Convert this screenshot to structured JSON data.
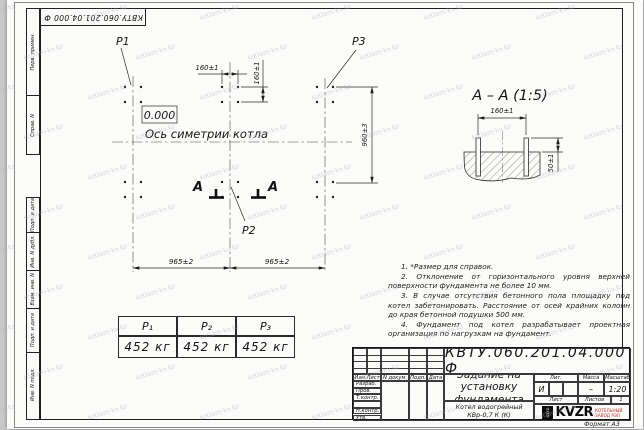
{
  "sheet": {
    "stamp_top": "КВТУ.060.201.04.000 Ф",
    "format_label": "Формат А3",
    "watermark": "kotlam-kv.kz"
  },
  "margin": {
    "perv_primen": "Перв. примен.",
    "sprav_n": "Справ. N",
    "podp_data_1": "Подп. и дата",
    "inv_dubl": "Инв. N дубл.",
    "vzam_inv": "Взам. инв. N",
    "podp_data_2": "Подп. и дата",
    "inv_podl": "Инв. N подл."
  },
  "plan": {
    "label_p1": "P1",
    "label_p2": "P2",
    "label_p3": "P3",
    "elevation": "0.000",
    "axis_label": "Ось симетрии котла",
    "dim_h160": "160±1",
    "dim_v160": "160±1",
    "dim_960": "960±3",
    "dim_965_left": "965±2",
    "dim_965_right": "965±2",
    "section_mark_left": "А",
    "section_mark_right": "А"
  },
  "section": {
    "title": "А – А (1:5)",
    "dim_160": "160±1",
    "dim_50": "50±1"
  },
  "notes": [
    "1. *Размер для справок.",
    "2. Отклонение от горизонтального уровня верхней поверхности фундамента не более 10 мм.",
    "3. В случае отсутствия бетонного пола площадку под котел забетонировать. Расстояние от осей крайних колонн до края бетонной подушки 500 мм.",
    "4. Фундамент под котел разрабатывает проектная организация по нагрузкам на фундамент."
  ],
  "load_table": {
    "headers": [
      "P₁",
      "P₂",
      "P₃"
    ],
    "values": [
      "452 кг",
      "452 кг",
      "452 кг"
    ]
  },
  "titleblock": {
    "designation": "КВТУ.060.201.04.000  Ф",
    "doc_title": "Задание на установку фундамента",
    "product": "Котел водогрейный КВр-0,7 К (К)",
    "col_izm": "Изм.Лист",
    "col_doc": "N докум.",
    "col_sign": "Подп.",
    "col_date": "Дата",
    "rows": [
      "Разраб.",
      "Пров.",
      "Т.контр.",
      "",
      "Н.контр.",
      "Утв."
    ],
    "lit_label": "Лит.",
    "mass_label": "Масса",
    "scale_label": "Масштаб",
    "lit_value": "И",
    "mass_value": "–",
    "scale_value": "1:20",
    "sheet_label": "Лист",
    "sheets_label": "Листов",
    "sheets_value": "1",
    "logo_ooo": "ООО",
    "logo_name": "KVZR",
    "logo_sub1": "КОТЕЛЬНЫЙ",
    "logo_sub2": "ЗАВОД РЭП"
  }
}
